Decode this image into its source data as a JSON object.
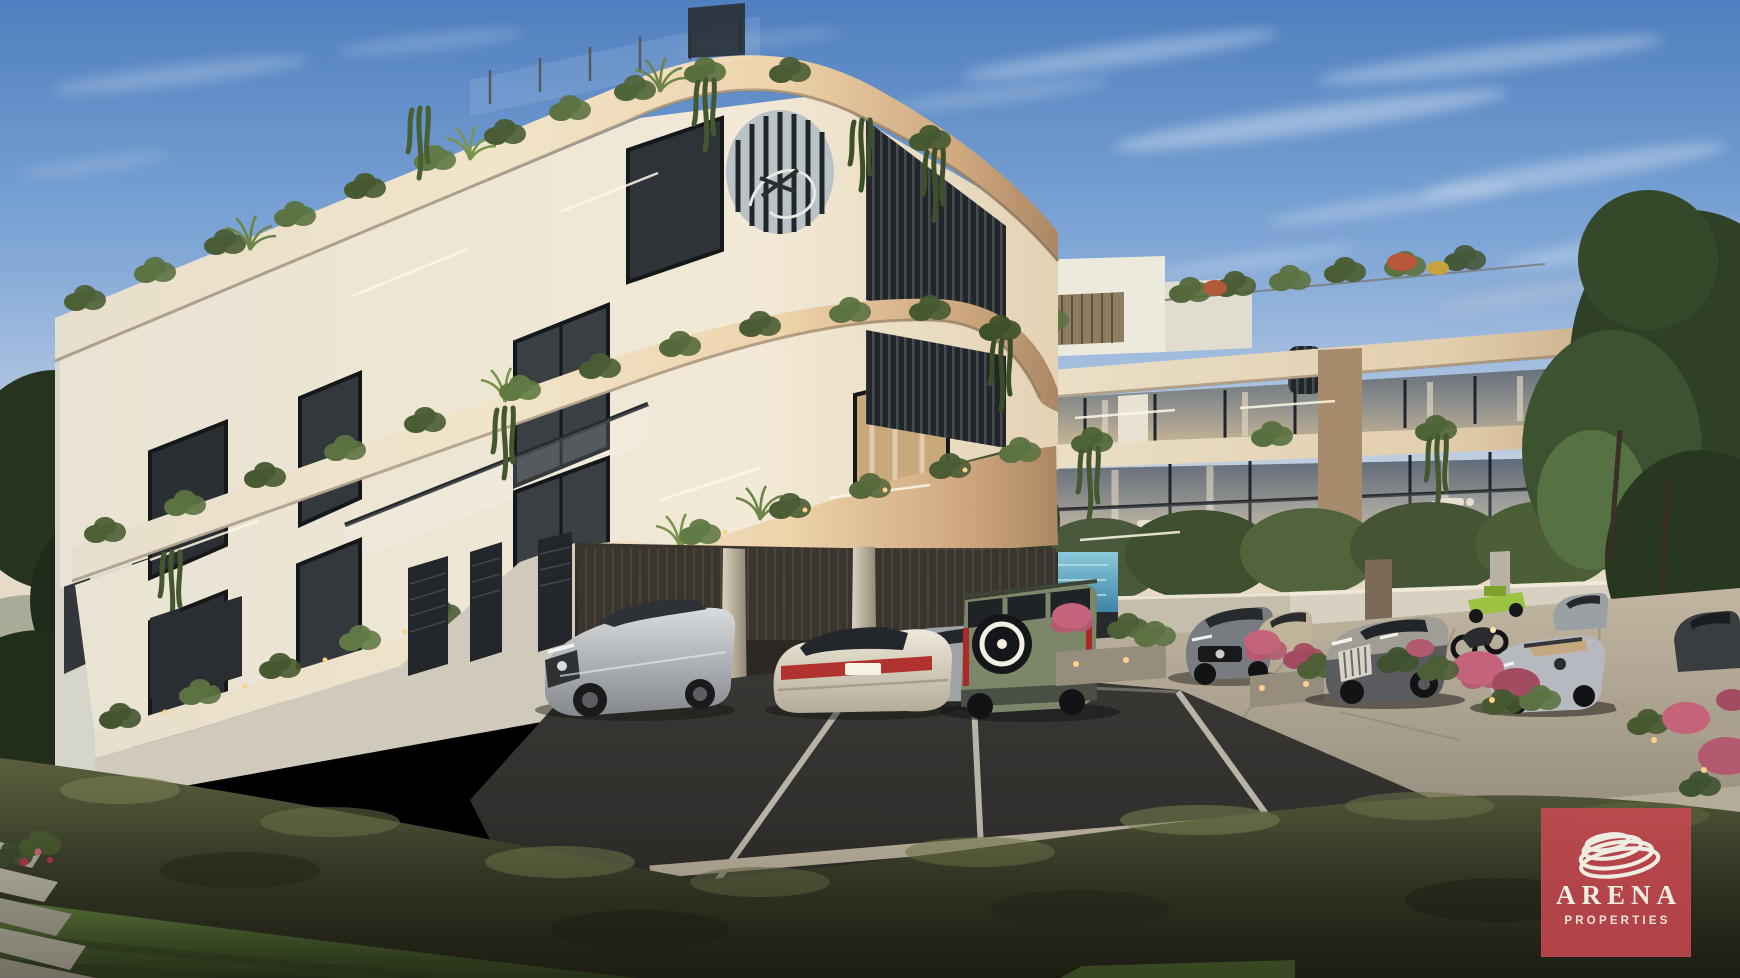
{
  "logo": {
    "title": "ARENA",
    "subtitle": "PROPERTIES",
    "brand_color": "#ca4850",
    "text_color": "#efece1",
    "icon": "arena-rings-icon"
  },
  "palette": {
    "sky_top": "#4f7fbf",
    "sky_horizon": "#e9dcc6",
    "facade_cream": "#efe8d8",
    "fascia_tan": "#c9a57f",
    "louver_dark": "#23262a",
    "foliage_dark": "#2f4026",
    "foliage_bright": "#74894c",
    "lawn_green": "#4e6c31",
    "hedge_olive": "#3f4730",
    "asphalt": "#2f2d2a",
    "concrete": "#a89f8f",
    "pool_blue": "#55a3c2",
    "flower_pink": "#c4637a",
    "uplight_warm": "#ffd289"
  },
  "scene": {
    "description": "Dusk architectural rendering of a modern three-storey apartment complex with rounded cream balconies, rooftop and balcony greenery, a spiral staircase, vertical louvre screens, covered parking with cars, a landscaped hedge, lawn and flowering planters.",
    "vehicles": [
      "silver sedan",
      "white sedan",
      "background silver sedan",
      "green SUV with spare wheel",
      "grey estate",
      "beige car",
      "dark luxury sedan",
      "lime quad bike",
      "motorcycle",
      "silver convertible",
      "dark car"
    ]
  }
}
